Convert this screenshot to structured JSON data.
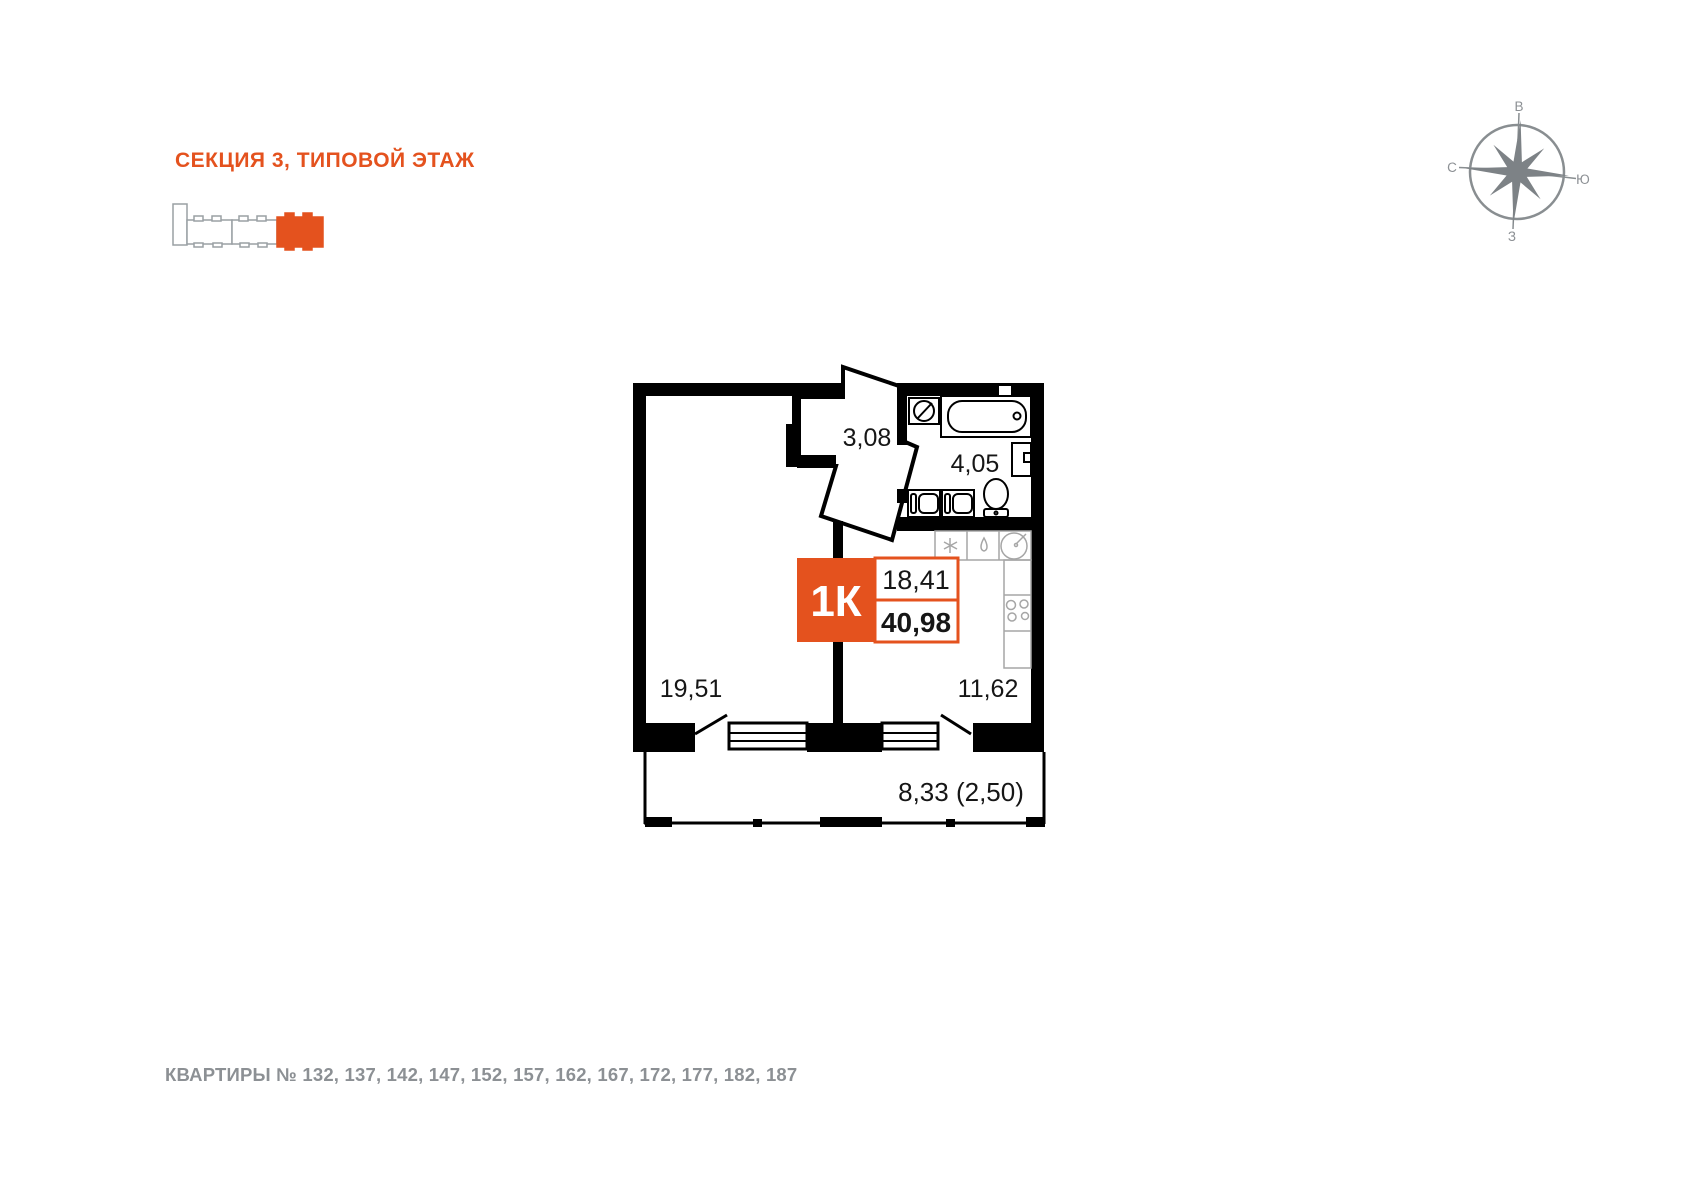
{
  "colors": {
    "accent": "#e4521e",
    "gray_text": "#8c9094",
    "outline_gray": "#9aa0a4",
    "plan_black": "#000000",
    "counter_gray": "#a6a6a6",
    "compass_gray": "#7d8286"
  },
  "header": {
    "section_title": "СЕКЦИЯ 3, ТИПОВОЙ ЭТАЖ"
  },
  "compass": {
    "top": "В",
    "left": "С",
    "right": "Ю",
    "bottom": "З"
  },
  "plan": {
    "badge": {
      "type": "1К",
      "room_area": "18,41",
      "total_area": "40,98"
    },
    "rooms": {
      "hallway": "3,08",
      "bathroom": "4,05",
      "living": "19,51",
      "kitchen": "11,62",
      "balcony": "8,33 (2,50)"
    }
  },
  "footer": {
    "apartments": "КВАРТИРЫ № 132, 137, 142, 147, 152, 157, 162, 167, 172, 177, 182, 187"
  }
}
